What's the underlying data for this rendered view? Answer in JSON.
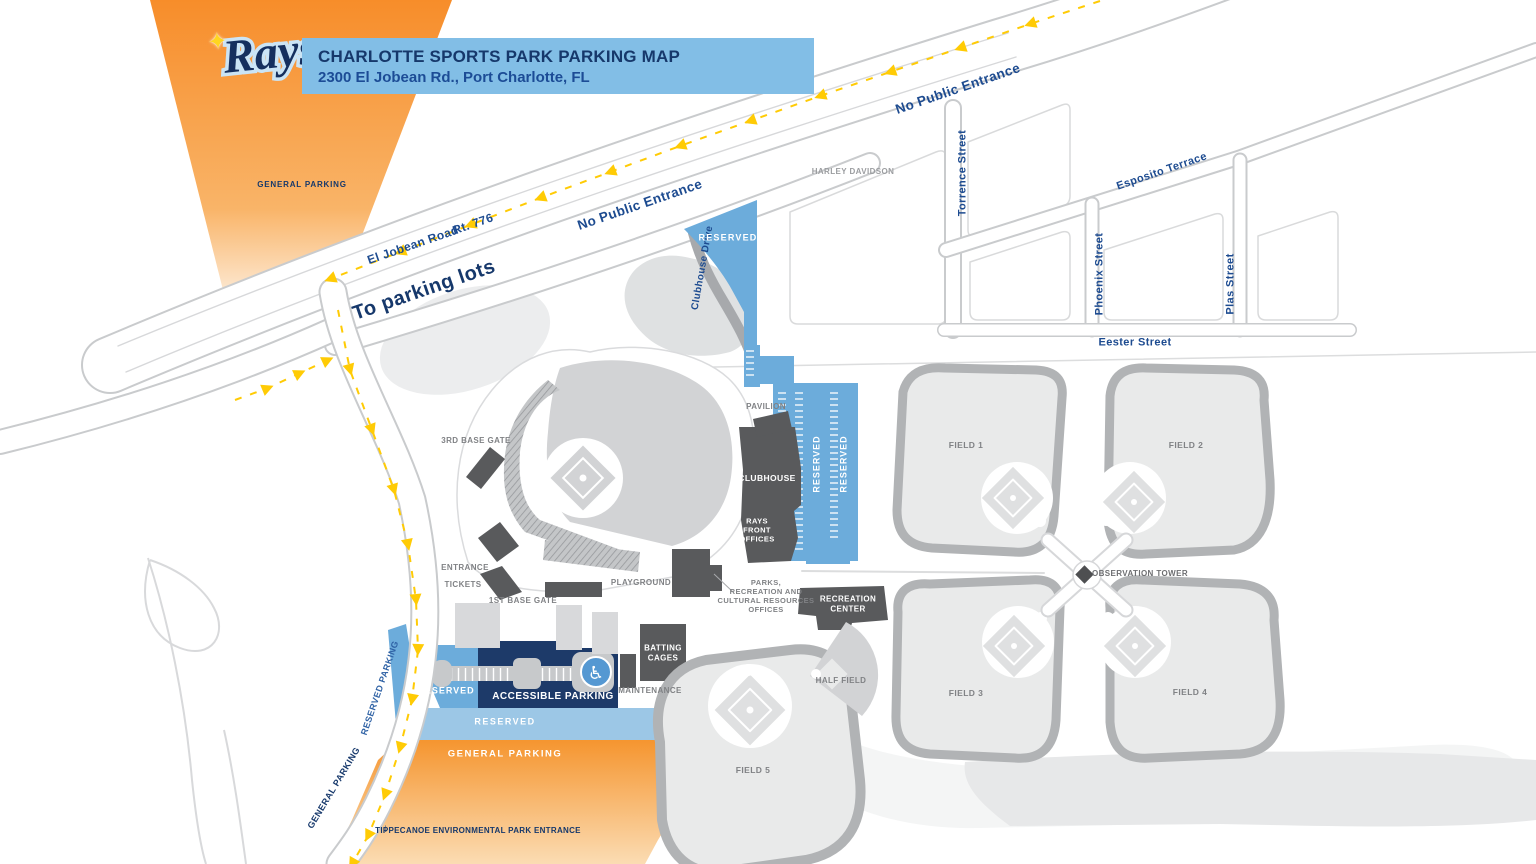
{
  "header": {
    "logo_text": "Rays",
    "logo_star": "✦",
    "logo_tm": "™",
    "title": "CHARLOTTE SPORTS PARK PARKING MAP",
    "subtitle": "2300 El Jobean Rd., Port Charlotte, FL"
  },
  "roads": {
    "el_jobean": "El Jobean Road",
    "rt_776": "Rt. 776",
    "no_public_entrance_west": "No Public Entrance",
    "no_public_entrance_east": "No Public Entrance",
    "to_parking_lots": "To parking lots",
    "clubhouse_drive": "Clubhouse Drive",
    "torrence": "Torrence Street",
    "esposito": "Esposito Terrace",
    "phoenix": "Phoenix Street",
    "plas": "Plas Street",
    "eester": "Eester Street"
  },
  "parking": {
    "general_nw": "GENERAL PARKING",
    "reserved_north": "RESERVED",
    "reserved_col_1": "RESERVED",
    "reserved_col_2": "RESERVED",
    "reserved_west": "RESERVED",
    "accessible": "ACCESSIBLE PARKING",
    "reserved_south": "RESERVED",
    "general_south": "GENERAL PARKING",
    "reserved_edge": "RESERVED PARKING",
    "general_edge": "GENERAL PARKING",
    "tippecanoe": "TIPPECANOE ENVIRONMENTAL PARK ENTRANCE",
    "tippecanoe_arrow": "↓"
  },
  "venues": {
    "harley": "HARLEY DAVIDSON",
    "third_base_gate": "3RD BASE GATE",
    "pavilion": "PAVILION",
    "clubhouse": "CLUBHOUSE",
    "rays_front_offices": "RAYS\nFRONT\nOFFICES",
    "entrance": "ENTRANCE",
    "tickets": "TICKETS",
    "first_base_gate": "1ST BASE GATE",
    "playground": "PLAYGROUND",
    "parks_offices": "PARKS,\nRECREATION AND\nCULTURAL RESOURCES\nOFFICES",
    "recreation_center": "RECREATION\nCENTER",
    "batting_cages": "BATTING\nCAGES",
    "maintenance": "MAINTENANCE"
  },
  "fields": {
    "field_1": "FIELD 1",
    "field_2": "FIELD 2",
    "field_3": "FIELD 3",
    "field_4": "FIELD 4",
    "field_5": "FIELD 5",
    "half_field": "HALF FIELD",
    "observation_tower": "OBSERVATION TOWER"
  },
  "icons": {
    "wheelchair": "♿",
    "tower_diamond": "diamond-icon"
  },
  "colors": {
    "orange": "#F5952F",
    "orange_light": "#FBDCB3",
    "lot_blue": "#6CACDB",
    "lot_light_blue": "#9CC7E6",
    "accessible_navy": "#1D3A69",
    "header_blue": "#82BEE6",
    "navy_text": "#16386B",
    "street_blue": "#1D4B90",
    "building_gray": "#595A5C",
    "field_fill": "#E9EAEA",
    "fence_gray": "#B1B3B5",
    "outfield_gray": "#D2D3D5",
    "label_gray": "#808285",
    "road_casing": "#C9CBCD",
    "arrow_yellow": "#FFCB05"
  }
}
